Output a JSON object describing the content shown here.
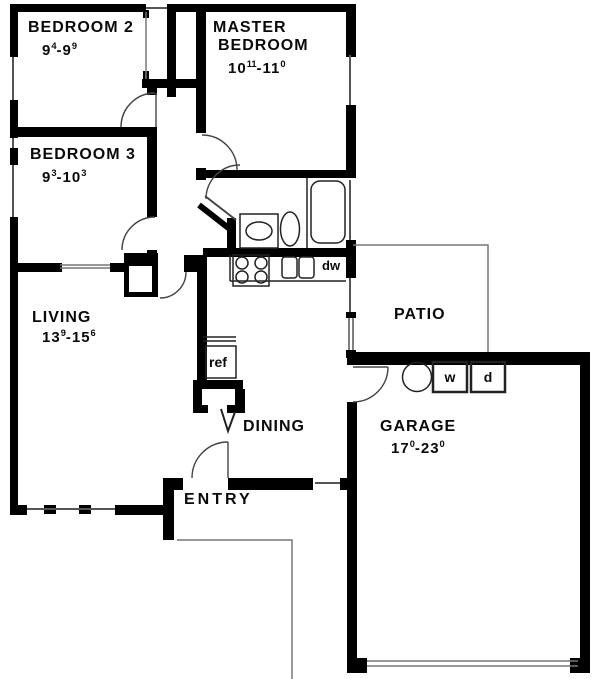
{
  "colors": {
    "ink": "#000000",
    "line": "#555555",
    "background": "#ffffff"
  },
  "rooms": {
    "bedroom2": {
      "label": "BEDROOM 2",
      "dim_a": "9",
      "dim_a_sup": "4",
      "dim_sep": "-",
      "dim_b": "9",
      "dim_b_sup": "9"
    },
    "master": {
      "label_line1": "MASTER",
      "label_line2": "BEDROOM",
      "dim_a": "10",
      "dim_a_sup": "11",
      "dim_sep": "-",
      "dim_b": "11",
      "dim_b_sup": "0"
    },
    "bedroom3": {
      "label": "BEDROOM 3",
      "dim_a": "9",
      "dim_a_sup": "3",
      "dim_sep": "-",
      "dim_b": "10",
      "dim_b_sup": "3"
    },
    "living": {
      "label": "LIVING",
      "dim_a": "13",
      "dim_a_sup": "9",
      "dim_sep": "-",
      "dim_b": "15",
      "dim_b_sup": "6"
    },
    "garage": {
      "label": "GARAGE",
      "dim_a": "17",
      "dim_a_sup": "0",
      "dim_sep": "-",
      "dim_b": "23",
      "dim_b_sup": "0"
    },
    "patio": {
      "label": "PATIO"
    },
    "dining": {
      "label": "DINING"
    },
    "entry": {
      "label": "ENTRY"
    }
  },
  "appliances": {
    "refrigerator": "ref",
    "dishwasher": "dw",
    "washer": "w",
    "dryer": "d"
  }
}
